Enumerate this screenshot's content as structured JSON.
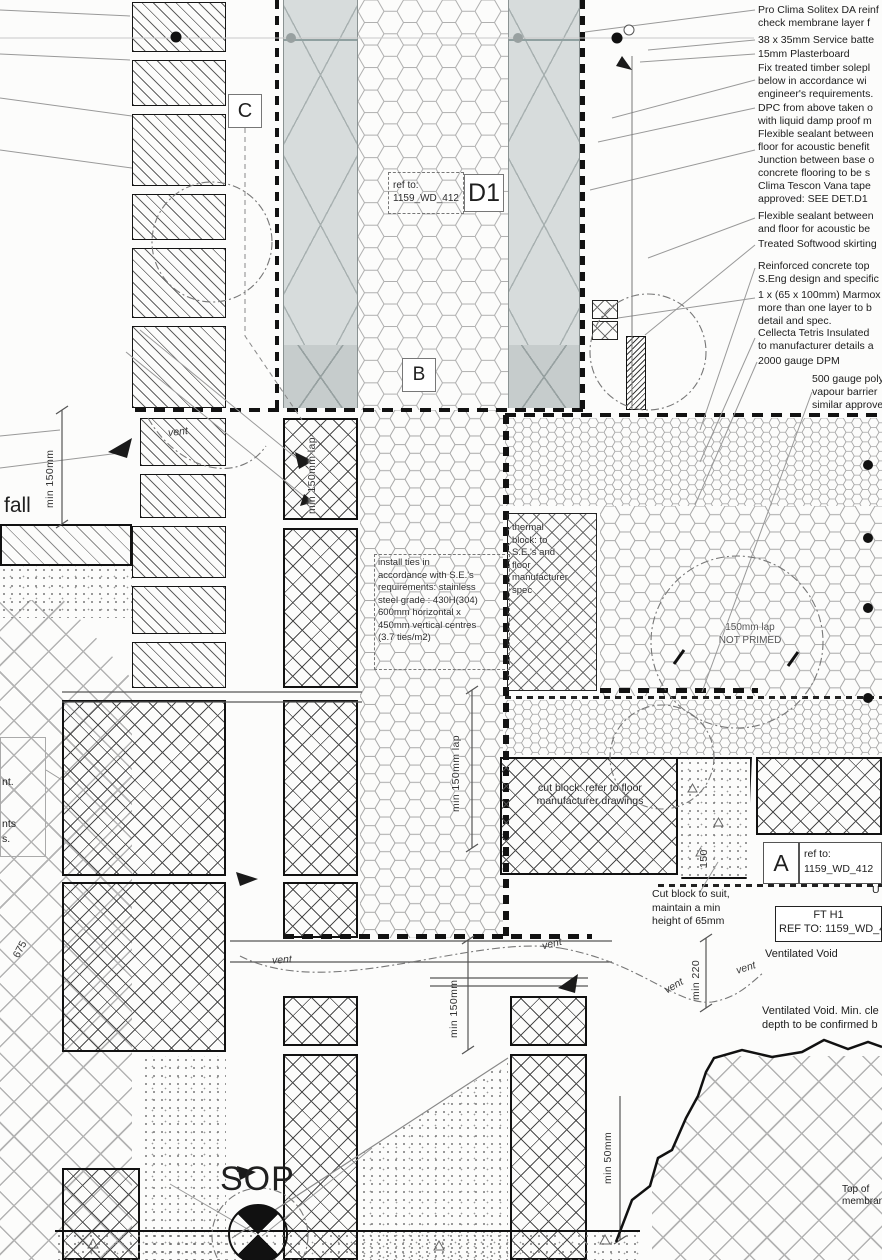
{
  "right_notes": [
    "Pro Clima Solitex DA reinf\ncheck membrane layer f",
    "38 x 35mm Service batte",
    "15mm Plasterboard",
    "Fix treated timber solepl\nbelow in accordance wi\nengineer's requirements.",
    "DPC from above taken o\nwith liquid damp proof m",
    "Flexible sealant between\nfloor for acoustic benefit\nJunction between base o\nconcrete flooring to be s\nClima Tescon Vana tape\napproved: SEE DET.D1",
    "Flexible sealant between\nand floor for acoustic be",
    "Treated Softwood skirting",
    "Reinforced concrete top\nS.Eng design and specific",
    "1 x (65 x 100mm) Marmox\nmore than one layer to b\ndetail and spec.",
    "Cellecta Tetris Insulated\nto manufacturer details a",
    "2000 gauge DPM",
    "500 gauge poly\nvapour barrier\nsimilar approve"
  ],
  "labels": {
    "c": "C",
    "b": "B",
    "d1": "D1",
    "a": "A"
  },
  "refs": {
    "d1_ref": "ref to:\n1159_WD_412",
    "a_ref": "ref to:\n1159_WD_412",
    "ft_line1": "FT H1",
    "ft_line2": "REF TO: 1159_WD_4"
  },
  "notes": {
    "install_ties": "install ties in\naccordance with S.E.'s\nrequirements: stainless\nsteel grade : 430H(304)\n600mm horizontal x\n450mm vertical centres\n(3.7 ties/m2)",
    "thermal_block": "thermal\nblock: to\nS.E.'s and\nfloor\nmanufacturer\nspec",
    "lap": "150mm lap\nNOT PRIMED",
    "cut_block": "cut block: refer to floor\nmanufacturer drawings",
    "cut_to_suit": "Cut block  to suit,\nmaintain a min\nheight of 65mm",
    "vent_void": "Ventilated Void",
    "vent_void_min": "Ventilated Void. Min. cle\ndepth to be confirmed b",
    "top_of": "Top of\nmembrane",
    "sop": "SOP",
    "fall": "fall",
    "frag_1": "nt.",
    "frag_2": "nts",
    "frag_3": "s.",
    "frag_u": "U"
  },
  "dims": {
    "min150_left": "min 150mm",
    "min150lap_block": "min 150mm lap",
    "min150lap_mid": "min 150mm lap",
    "min150_bottom": "min 150mm",
    "min50": "min 50mm",
    "min220": "min 220",
    "pad150": "150",
    "d675": "675"
  },
  "vent_label": "vent"
}
